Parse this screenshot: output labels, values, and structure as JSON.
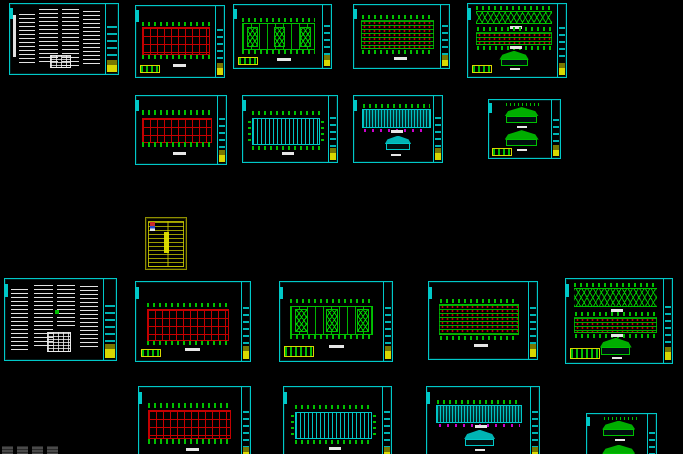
{
  "canvas": {
    "width": 683,
    "height": 454,
    "background": "#000000",
    "application": "cad-model-space"
  },
  "colors": {
    "frame": "#00c8c8",
    "frame_dim": "#007a7a",
    "grid_red": "#c40000",
    "detail_green": "#00c000",
    "annotation_yellow": "#d8d800",
    "hatch_cyan": "#00c8c8",
    "magenta": "#cc00cc",
    "text_white": "#e6e6e6",
    "watermark_gray": "#4a4a4a"
  },
  "sheets": [
    {
      "id": "general-notes-1",
      "type": "general-notes",
      "row": 1,
      "caption_legible": false
    },
    {
      "id": "grid-plan-1",
      "type": "red-column-grid-plan",
      "row": 1,
      "caption_legible": false
    },
    {
      "id": "bracing-plan-1",
      "type": "x-braced-roof-plan",
      "row": 1,
      "caption_legible": false
    },
    {
      "id": "purlin-plan-1",
      "type": "purlin-layout-plan",
      "row": 1,
      "caption_legible": false
    },
    {
      "id": "elevations-1",
      "type": "stacked-elevations",
      "row": 1,
      "caption_legible": false
    },
    {
      "id": "grid-plan-2",
      "type": "red-column-grid-plan",
      "row": 2,
      "caption_legible": false
    },
    {
      "id": "sheeting-plan-1",
      "type": "cyan-sheeting-plan",
      "row": 2,
      "caption_legible": false
    },
    {
      "id": "elevation-section-1",
      "type": "elevation-and-section",
      "row": 2,
      "caption_legible": false
    },
    {
      "id": "frame-sections-1",
      "type": "gable-frame-sections",
      "row": 2,
      "caption_legible": false
    },
    {
      "id": "drawing-list",
      "type": "yellow-schedule-table",
      "row": 3,
      "caption_legible": false
    },
    {
      "id": "general-notes-2",
      "type": "general-notes",
      "row": 4,
      "caption_legible": false
    },
    {
      "id": "grid-plan-3",
      "type": "red-column-grid-plan",
      "row": 4,
      "caption_legible": false
    },
    {
      "id": "bracing-plan-2",
      "type": "x-braced-roof-plan",
      "row": 4,
      "caption_legible": false
    },
    {
      "id": "purlin-plan-2",
      "type": "purlin-layout-plan",
      "row": 4,
      "caption_legible": false
    },
    {
      "id": "elevations-2",
      "type": "stacked-elevations",
      "row": 4,
      "caption_legible": false
    },
    {
      "id": "grid-plan-4",
      "type": "red-column-grid-plan",
      "row": 5,
      "caption_legible": false
    },
    {
      "id": "sheeting-plan-2",
      "type": "cyan-sheeting-plan",
      "row": 5,
      "caption_legible": false
    },
    {
      "id": "elevation-section-2",
      "type": "elevation-and-section",
      "row": 5,
      "caption_legible": false
    },
    {
      "id": "frame-sections-2",
      "type": "gable-frame-sections",
      "row": 5,
      "caption_legible": false
    }
  ],
  "watermark": {
    "present": true,
    "legible": false,
    "clipped": true
  }
}
